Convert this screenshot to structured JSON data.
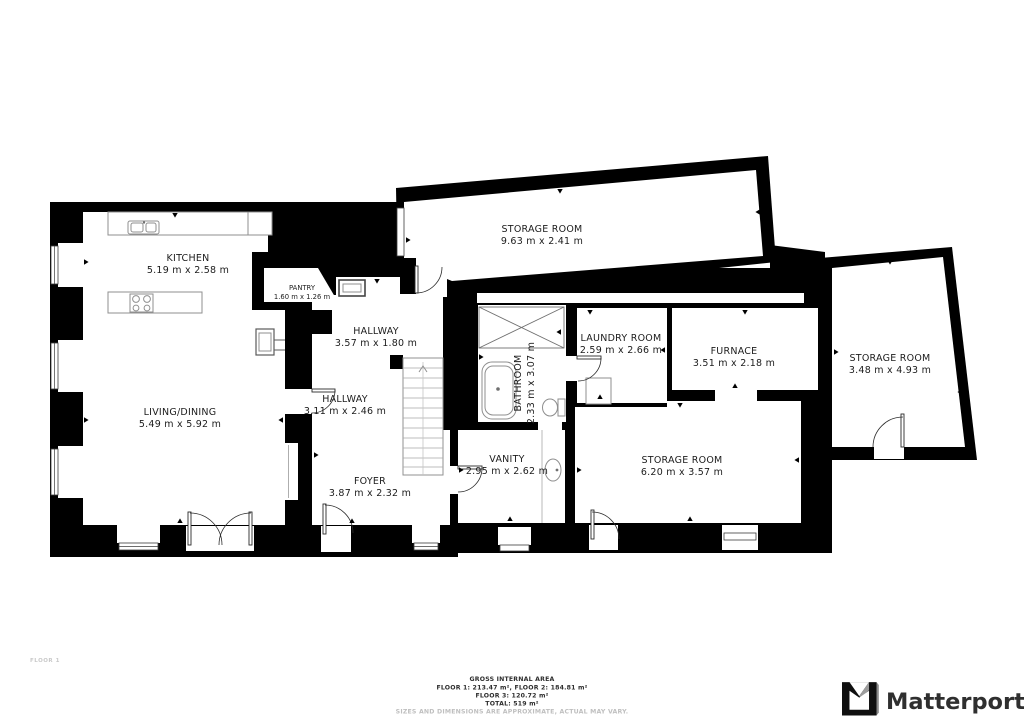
{
  "floor_plan": {
    "floor_label": "FLOOR 1",
    "rooms": {
      "kitchen": {
        "name": "KITCHEN",
        "dims": "5.19 m x 2.58 m"
      },
      "living_dining": {
        "name": "LIVING/DINING",
        "dims": "5.49 m x 5.92 m"
      },
      "pantry": {
        "name": "PANTRY",
        "dims": "1.60 m x 1.26 m"
      },
      "hallway_upper": {
        "name": "HALLWAY",
        "dims": "3.57 m x 1.80 m"
      },
      "hallway_lower": {
        "name": "HALLWAY",
        "dims": "3.11 m x 2.46 m"
      },
      "foyer": {
        "name": "FOYER",
        "dims": "3.87 m x 2.32 m"
      },
      "bathroom": {
        "name": "BATHROOM",
        "dims": "2.33 m x 3.07 m"
      },
      "vanity": {
        "name": "VANITY",
        "dims": "2.95 m x 2.62 m"
      },
      "laundry_room": {
        "name": "LAUNDRY ROOM",
        "dims": "2.59 m x 2.66 m"
      },
      "furnace": {
        "name": "FURNACE",
        "dims": "3.51 m x 2.18 m"
      },
      "storage_top": {
        "name": "STORAGE ROOM",
        "dims": "9.63 m x 2.41 m"
      },
      "storage_right": {
        "name": "STORAGE ROOM",
        "dims": "3.48 m x 4.93 m"
      },
      "storage_bottom": {
        "name": "STORAGE ROOM",
        "dims": "6.20 m x 3.57 m"
      }
    }
  },
  "footer": {
    "title": "GROSS INTERNAL AREA",
    "areas_line1": "FLOOR 1: 213.47 m², FLOOR 2: 184.81 m²",
    "areas_line2": "FLOOR 3: 120.72 m²",
    "total": "TOTAL: 519 m²",
    "disclaimer": "SIZES AND DIMENSIONS ARE APPROXIMATE, ACTUAL MAY VARY."
  },
  "branding": {
    "logo_text": "Matterport"
  },
  "colors": {
    "wall": "#000000",
    "floor": "#ffffff",
    "fixture_stroke": "#8f8f8f",
    "label_text": "#1c1c1c",
    "footer_text": "#2e2e2e",
    "muted_text": "#bfbfbf",
    "floor_tag_text": "#c9c9c9",
    "logo_color": "#2f2f2f"
  }
}
